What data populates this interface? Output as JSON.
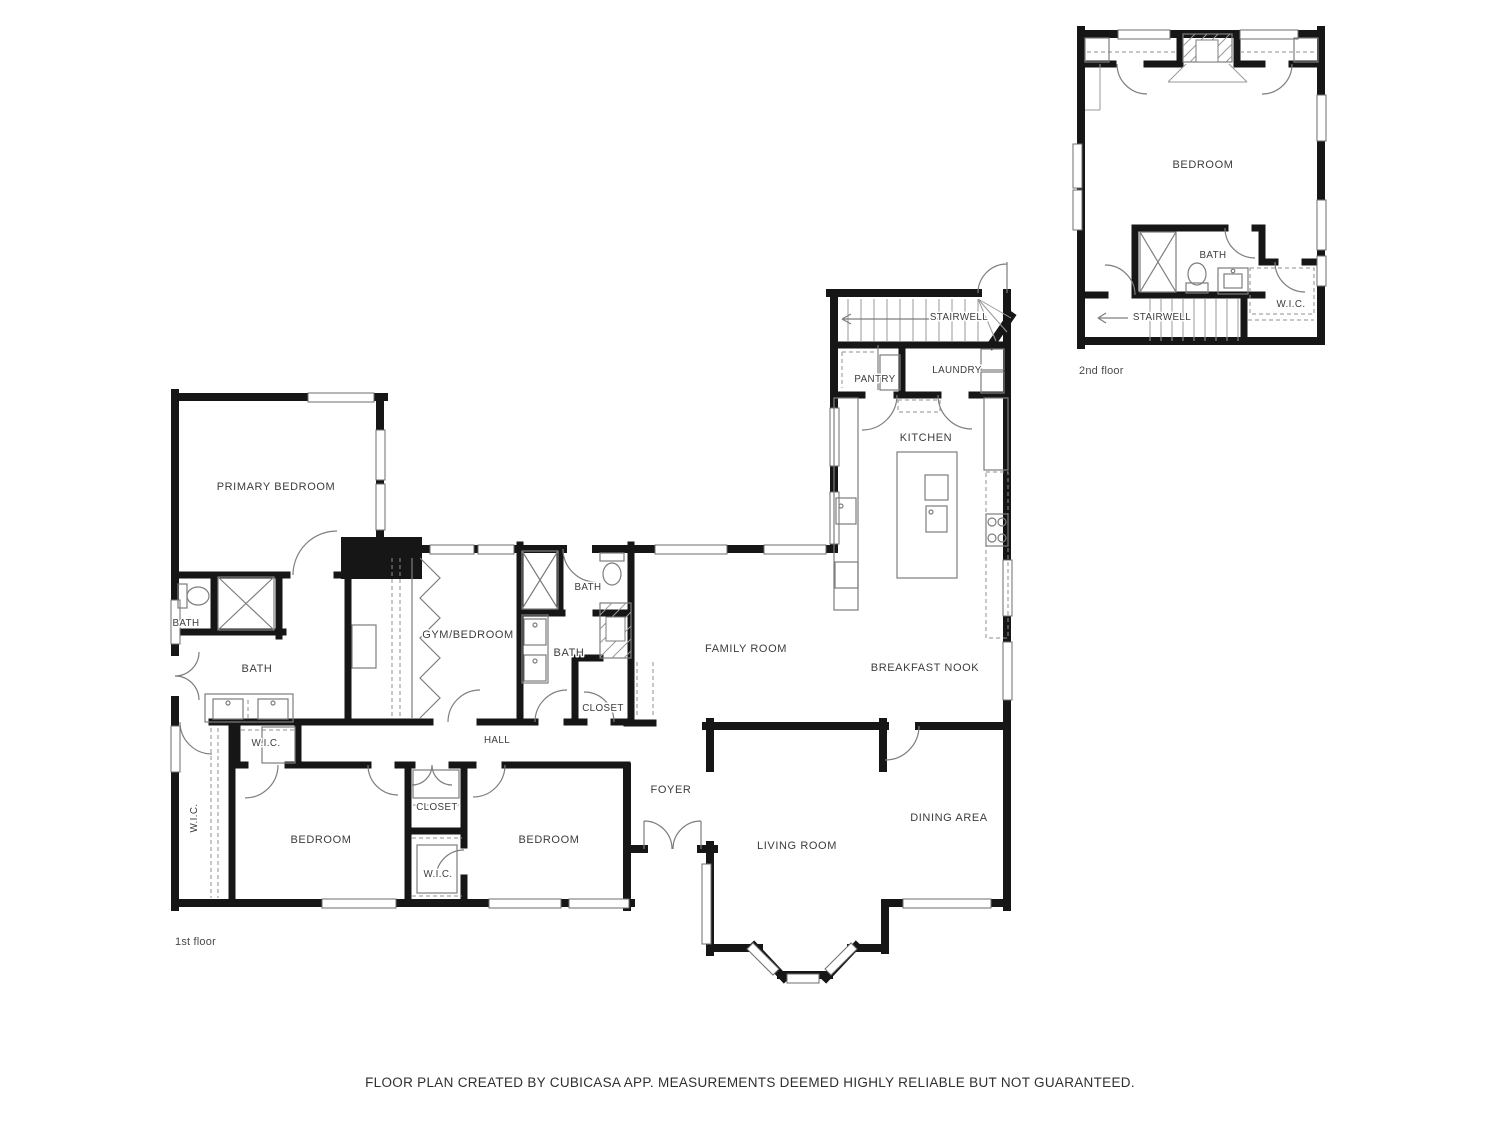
{
  "colors": {
    "wall": "#161616",
    "line": "#7d7d7d",
    "text": "#3c3c3c"
  },
  "footer": {
    "disclaimer": "FLOOR PLAN CREATED BY CUBICASA APP. MEASUREMENTS DEEMED HIGHLY RELIABLE BUT NOT GUARANTEED."
  },
  "first_floor": {
    "caption": "1st floor",
    "labels": {
      "primary_bedroom": "PRIMARY BEDROOM",
      "bath_toilet": "BATH",
      "bath_primary": "BATH",
      "gym_bedroom": "GYM/BEDROOM",
      "bath_upper": "BATH",
      "bath_hall": "BATH",
      "closet_hall": "CLOSET",
      "hall": "HALL",
      "family_room": "FAMILY ROOM",
      "breakfast_nook": "BREAKFAST NOOK",
      "kitchen": "KITCHEN",
      "pantry": "PANTRY",
      "laundry": "LAUNDRY",
      "stairwell": "STAIRWELL",
      "wic_strip": "W.I.C.",
      "wic_small": "W.I.C.",
      "bedroom_left": "BEDROOM",
      "closet_mid": "CLOSET",
      "wic_mid": "W.I.C.",
      "bedroom_right": "BEDROOM",
      "foyer": "FOYER",
      "living_room": "LIVING ROOM",
      "dining_area": "DINING AREA"
    }
  },
  "second_floor": {
    "caption": "2nd floor",
    "labels": {
      "bedroom": "BEDROOM",
      "bath": "BATH",
      "wic": "W.I.C.",
      "stairwell": "STAIRWELL"
    }
  }
}
